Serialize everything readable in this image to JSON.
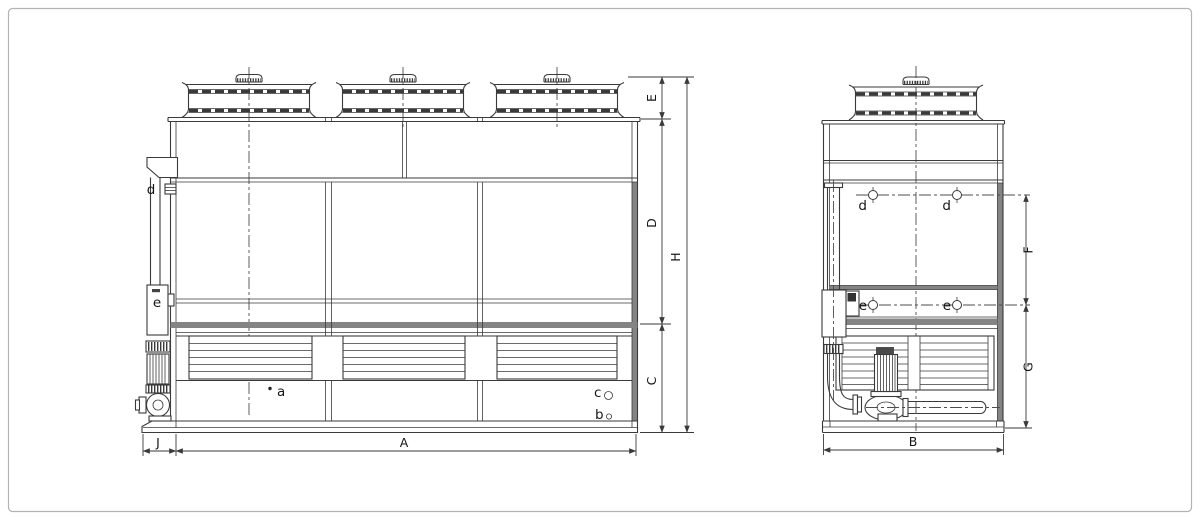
{
  "page": {
    "background": "#ffffff",
    "border_color": "#b3b3b3"
  },
  "colors": {
    "line": "#3a3a3a",
    "band_gray": "#848484"
  },
  "front_view": {
    "dimensions": {
      "A": "A",
      "C": "C",
      "D": "D",
      "E": "E",
      "H": "H",
      "J": "J"
    },
    "connections": {
      "a": "a",
      "b": "b",
      "c": "c",
      "d": "d",
      "e": "e"
    }
  },
  "side_view": {
    "dimensions": {
      "B": "B",
      "F": "F",
      "G": "G"
    },
    "connections": {
      "d_left": "d",
      "d_right": "d",
      "e_left": "e",
      "e_right": "e"
    }
  }
}
